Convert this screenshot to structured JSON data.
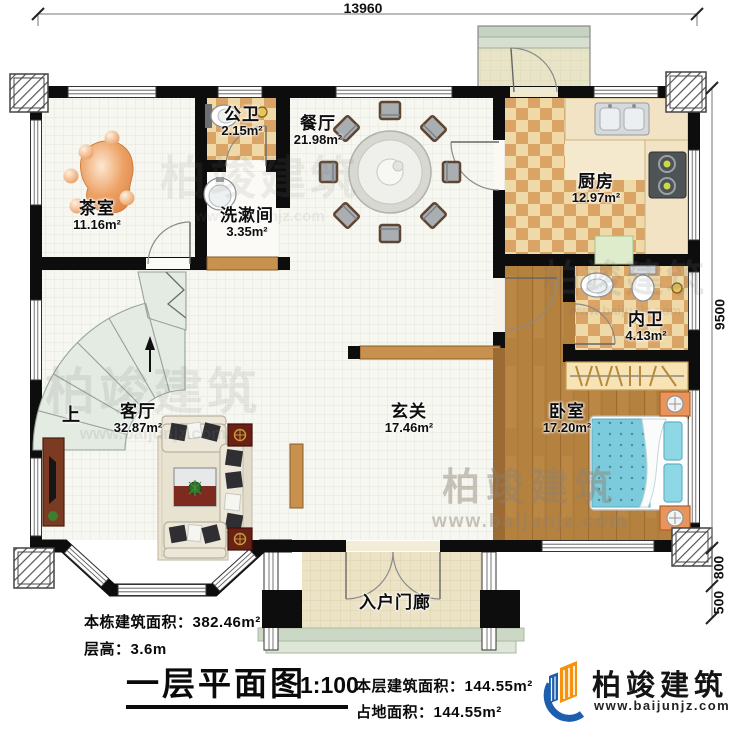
{
  "dimensions": {
    "top": "13960",
    "right_main": "9500",
    "right_bay": "800",
    "right_steps": "500"
  },
  "rooms": [
    {
      "name": "茶室",
      "area": "11.16m²"
    },
    {
      "name": "公卫",
      "area": "2.15m²"
    },
    {
      "name": "洗漱间",
      "area": "3.35m²"
    },
    {
      "name": "餐厅",
      "area": "21.98m²"
    },
    {
      "name": "厨房",
      "area": "12.97m²"
    },
    {
      "name": "内卫",
      "area": "4.13m²"
    },
    {
      "name": "卧室",
      "area": "17.20m²"
    },
    {
      "name": "玄关",
      "area": "17.46m²"
    },
    {
      "name": "客厅",
      "area": "32.87m²"
    },
    {
      "name": "入户门廊",
      "area": ""
    }
  ],
  "stairs": {
    "up_label": "上"
  },
  "notes": {
    "building_total": "本栋建筑面积：382.46m²",
    "floor_height": "层高：3.6m",
    "floor_area": "本层建筑面积：144.55m²",
    "land_area": "占地面积：144.55m²"
  },
  "title": {
    "text": "一层平面图",
    "scale": "1:100"
  },
  "logo": {
    "name": "柏竣建筑",
    "url": "www.baijunjz.com"
  },
  "watermark": {
    "brand": "柏竣建筑",
    "url": "www.baijunjz.com"
  },
  "colors": {
    "wall": "#0d0d0d",
    "checker_light": "#efd9a7",
    "checker_dark": "#d9a465",
    "wood_floor": "#b5813f",
    "bed_blue": "#7ccbdd",
    "stair_green": "#e3ebe2",
    "logo_blue": "#1d5fae",
    "logo_orange": "#f5930f"
  }
}
